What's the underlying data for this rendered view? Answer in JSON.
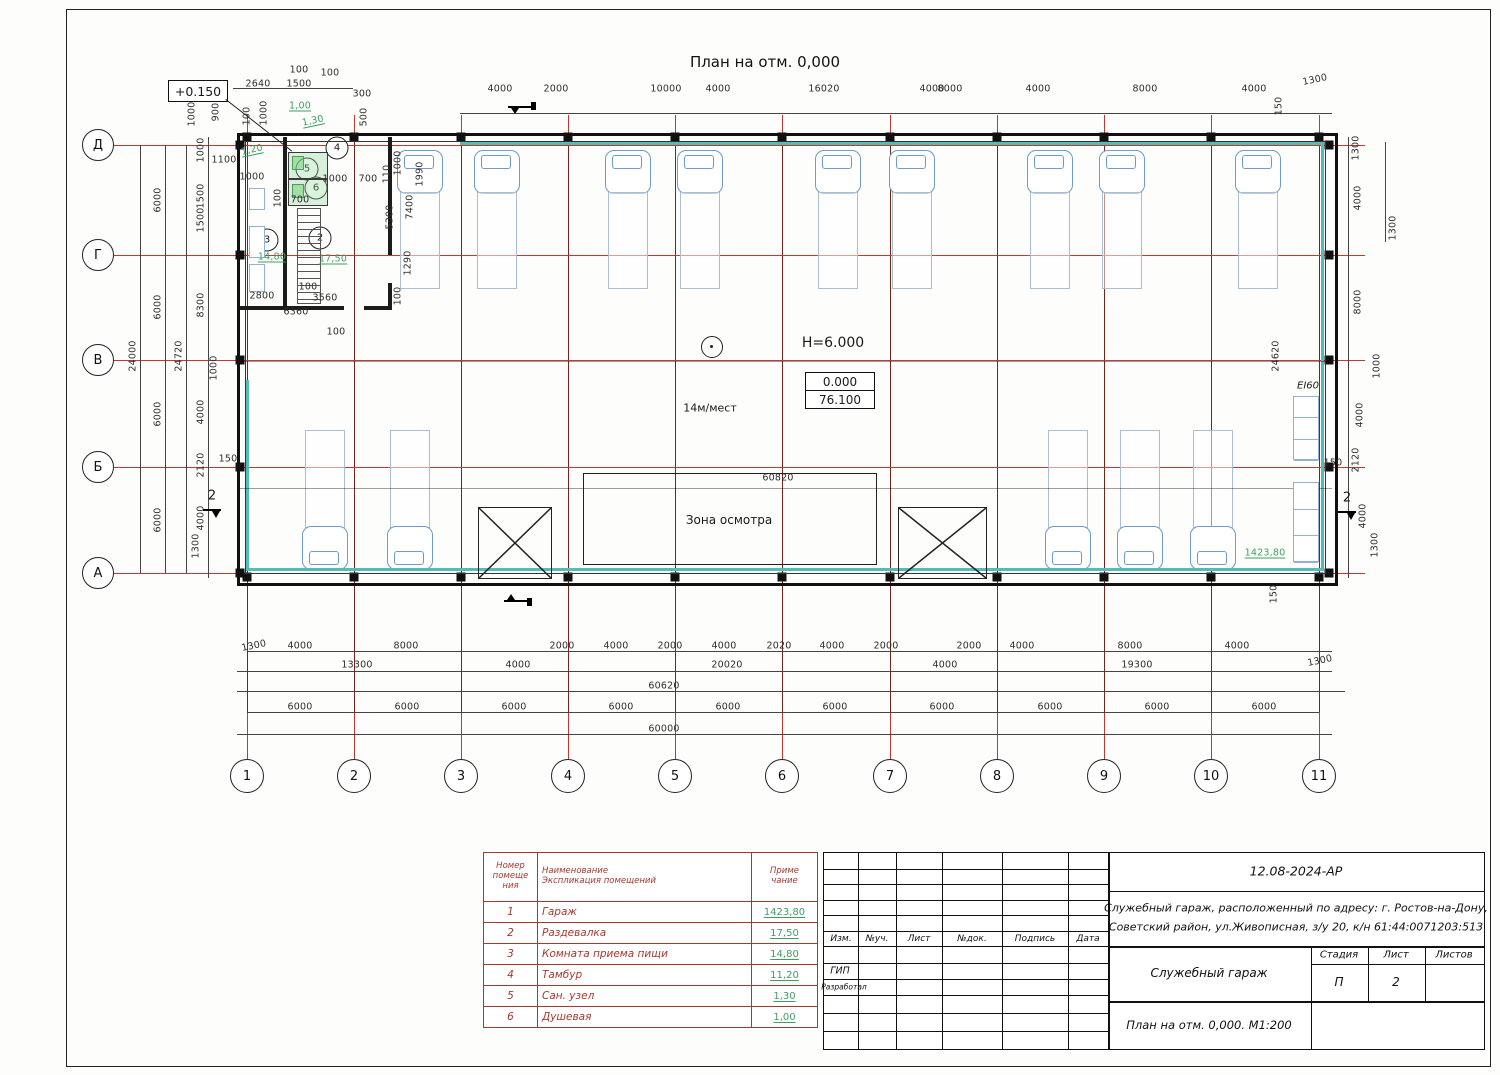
{
  "meta": {
    "sheet_title": "План на отм. 0,000"
  },
  "annotations": {
    "elev_mark": "+0.150",
    "height_mark": "H=6.000",
    "level_top": "0.000",
    "level_bottom": "76.100",
    "places": "14м/мест",
    "zone_label": "Зона осмотра",
    "fire_rating": "EI60",
    "section2": "2"
  },
  "axes": {
    "cols": [
      "1",
      "2",
      "3",
      "4",
      "5",
      "6",
      "7",
      "8",
      "9",
      "10",
      "11"
    ],
    "rows": [
      "Д",
      "Г",
      "В",
      "Б",
      "А"
    ]
  },
  "room_tags": [
    "2",
    "3",
    "4",
    "5",
    "6"
  ],
  "dims": [
    [
      "2640",
      258,
      84
    ],
    [
      "100",
      299,
      70
    ],
    [
      "1500",
      299,
      84
    ],
    [
      "100",
      330,
      73
    ],
    [
      "300",
      362,
      94
    ],
    [
      "4000",
      500,
      89
    ],
    [
      "2000",
      556,
      89
    ],
    [
      "10000",
      666,
      89
    ],
    [
      "4000",
      718,
      89
    ],
    [
      "16020",
      824,
      89
    ],
    [
      "4000",
      932,
      89
    ],
    [
      "8000",
      950,
      89
    ],
    [
      "4000",
      1038,
      89
    ],
    [
      "8000",
      1145,
      89
    ],
    [
      "4000",
      1254,
      89
    ],
    [
      "1300",
      1315,
      80,
      "sl"
    ],
    [
      "150",
      1279,
      106,
      "r"
    ],
    [
      "1300",
      1393,
      228,
      "r"
    ],
    [
      "1000",
      192,
      114,
      "r"
    ],
    [
      "900",
      216,
      112,
      "r"
    ],
    [
      "100",
      247,
      116,
      "r"
    ],
    [
      "1000",
      264,
      113,
      "r"
    ],
    [
      "500",
      364,
      117,
      "r"
    ],
    [
      "1000",
      398,
      163,
      "r"
    ],
    [
      "1990",
      420,
      174,
      "r"
    ],
    [
      "1,00",
      300,
      106,
      "g"
    ],
    [
      "1,30",
      313,
      121,
      "gsl"
    ],
    [
      "1,20",
      252,
      150,
      "gsl"
    ],
    [
      "1100",
      224,
      160
    ],
    [
      "1000",
      252,
      177
    ],
    [
      "1000",
      335,
      179
    ],
    [
      "700",
      368,
      179
    ],
    [
      "110",
      387,
      174,
      "r"
    ],
    [
      "700",
      300,
      200
    ],
    [
      "100",
      278,
      198,
      "r"
    ],
    [
      "5300",
      390,
      217,
      "r"
    ],
    [
      "7400",
      410,
      207,
      "r"
    ],
    [
      "1290",
      408,
      263,
      "r"
    ],
    [
      "100",
      398,
      296,
      "r"
    ],
    [
      "14,80",
      272,
      257,
      "g"
    ],
    [
      "17,50",
      333,
      259,
      "g"
    ],
    [
      "2800",
      262,
      296
    ],
    [
      "100",
      308,
      287
    ],
    [
      "3560",
      325,
      298
    ],
    [
      "6360",
      296,
      312
    ],
    [
      "100",
      336,
      332
    ],
    [
      "60820",
      778,
      478
    ],
    [
      "1423,80",
      1265,
      553,
      "g"
    ],
    [
      "24000",
      133,
      356,
      "r"
    ],
    [
      "6000",
      158,
      200,
      "r"
    ],
    [
      "6000",
      158,
      307,
      "r"
    ],
    [
      "6000",
      158,
      414,
      "r"
    ],
    [
      "6000",
      158,
      520,
      "r"
    ],
    [
      "24720",
      179,
      356,
      "r"
    ],
    [
      "1000",
      201,
      150,
      "r"
    ],
    [
      "1500",
      201,
      196,
      "r"
    ],
    [
      "1500",
      201,
      220,
      "r"
    ],
    [
      "8300",
      201,
      305,
      "r"
    ],
    [
      "1000",
      214,
      368,
      "r"
    ],
    [
      "4000",
      201,
      412,
      "r"
    ],
    [
      "2120",
      201,
      465,
      "r"
    ],
    [
      "150",
      228,
      459
    ],
    [
      "4000",
      201,
      518,
      "r"
    ],
    [
      "1300",
      196,
      546,
      "r"
    ],
    [
      "1300",
      1356,
      148,
      "r"
    ],
    [
      "4000",
      1358,
      198,
      "r"
    ],
    [
      "8000",
      1358,
      302,
      "r"
    ],
    [
      "24620",
      1276,
      356,
      "r"
    ],
    [
      "1000",
      1377,
      366,
      "r"
    ],
    [
      "4000",
      1360,
      415,
      "r"
    ],
    [
      "2120",
      1356,
      460,
      "r"
    ],
    [
      "150",
      1333,
      463
    ],
    [
      "4000",
      1363,
      516,
      "r"
    ],
    [
      "1300",
      1375,
      545,
      "r"
    ],
    [
      "150",
      1274,
      594,
      "r"
    ],
    [
      "1300",
      254,
      646,
      "sl"
    ],
    [
      "4000",
      300,
      646
    ],
    [
      "8000",
      406,
      646
    ],
    [
      "2000",
      562,
      646
    ],
    [
      "4000",
      616,
      646
    ],
    [
      "2000",
      670,
      646
    ],
    [
      "4000",
      724,
      646
    ],
    [
      "2020",
      779,
      646
    ],
    [
      "4000",
      832,
      646
    ],
    [
      "2000",
      886,
      646
    ],
    [
      "2000",
      969,
      646
    ],
    [
      "4000",
      1022,
      646
    ],
    [
      "8000",
      1130,
      646
    ],
    [
      "4000",
      1237,
      646
    ],
    [
      "13300",
      357,
      665
    ],
    [
      "4000",
      518,
      665
    ],
    [
      "20020",
      727,
      665
    ],
    [
      "4000",
      945,
      665
    ],
    [
      "19300",
      1137,
      665
    ],
    [
      "1300",
      1320,
      661,
      "sl"
    ],
    [
      "60620",
      664,
      686
    ],
    [
      "6000",
      300,
      707
    ],
    [
      "6000",
      407,
      707
    ],
    [
      "6000",
      514,
      707
    ],
    [
      "6000",
      621,
      707
    ],
    [
      "6000",
      728,
      707
    ],
    [
      "6000",
      835,
      707
    ],
    [
      "6000",
      942,
      707
    ],
    [
      "6000",
      1050,
      707
    ],
    [
      "6000",
      1157,
      707
    ],
    [
      "6000",
      1264,
      707
    ],
    [
      "60000",
      664,
      729
    ]
  ],
  "legend": {
    "headers": [
      "Номер\nпомеще\nния",
      "Наименование\nЭкспликация помещений",
      "Приме\nчание"
    ],
    "rows": [
      [
        "1",
        "Гараж",
        "1423,80"
      ],
      [
        "2",
        "Раздевалка",
        "17,50"
      ],
      [
        "3",
        "Комната приема пищи",
        "14,80"
      ],
      [
        "4",
        "Тамбур",
        "11,20"
      ],
      [
        "5",
        "Сан. узел",
        "1,30"
      ],
      [
        "6",
        "Душевая",
        "1,00"
      ]
    ]
  },
  "titleblock": {
    "doc_code": "12.08-2024-АР",
    "project_line1": "Служебный гараж,  расположенный по адресу: г. Ростов-на-Дону,",
    "project_line2": "Советский район, ул.Живописная, з/у 20, к/н 61:44:0071203:513",
    "object_name": "Служебный гараж",
    "sheet_name": "План на отм. 0,000. М1:200",
    "cols": [
      "Изм.",
      "№уч.",
      "Лист",
      "№док.",
      "Подпись",
      "Дата"
    ],
    "roles": [
      "ГИП",
      "Разработал"
    ],
    "stage_label": "Стадия",
    "sheet_label": "Лист",
    "sheets_label": "Листов",
    "stage": "П",
    "sheet_no": "2"
  }
}
